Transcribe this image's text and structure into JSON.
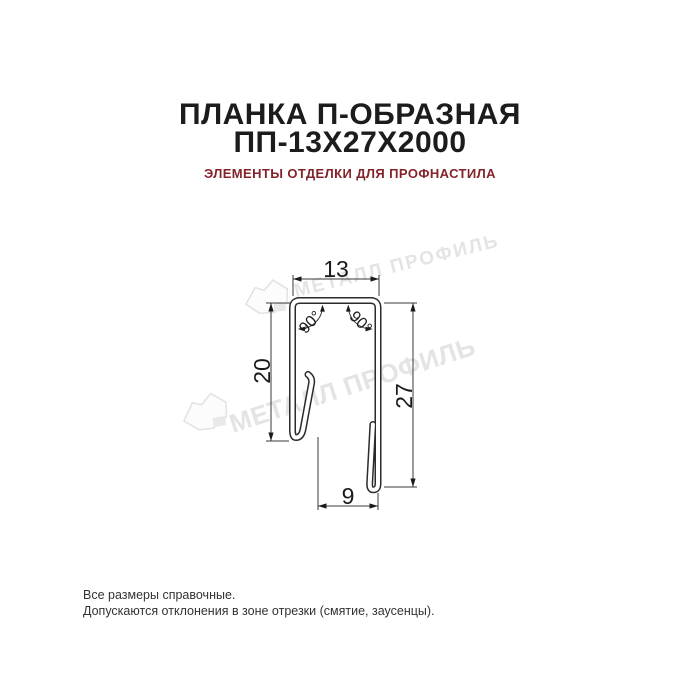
{
  "header": {
    "title_line1": "ПЛАНКА П-ОБРАЗНАЯ",
    "title_line2": "ПП-13Х27Х2000",
    "subtitle": "ЭЛЕМЕНТЫ ОТДЕЛКИ ДЛЯ ПРОФНАСТИЛА"
  },
  "drawing": {
    "dim_top_width": "13",
    "dim_left_height": "20",
    "dim_right_height": "27",
    "dim_bottom_width": "9",
    "angle_left": "90°",
    "angle_right": "90°"
  },
  "watermark": {
    "text": "МЕТАЛЛ ПРОФИЛЬ"
  },
  "footer": {
    "line1": "Все размеры справочные.",
    "line2": "Допускаются отклонения в зоне отрезки (смятие, заусенцы)."
  },
  "colors": {
    "title": "#1c1c1c",
    "subtitle": "#84232a",
    "drawing_line": "#2b2b2b",
    "dimension_line": "#3a3a3a",
    "watermark": "#e4e4e4",
    "background": "#ffffff"
  }
}
